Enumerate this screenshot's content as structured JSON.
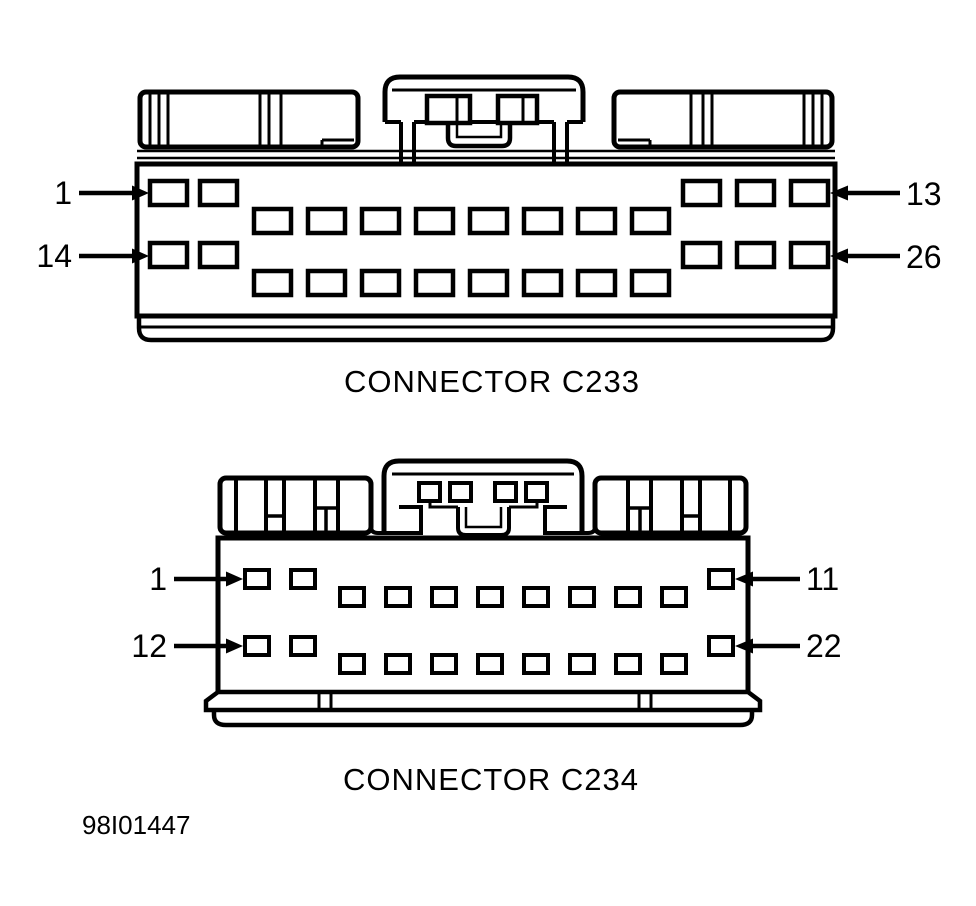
{
  "figure": {
    "code": "98I01447"
  },
  "colors": {
    "line": "#000000",
    "background": "#ffffff"
  },
  "connectors": [
    {
      "id": "C233",
      "caption": "CONNECTOR C233",
      "rows": 2,
      "pins_per_row": 13,
      "total_pins": 26,
      "pin_groups": [
        {
          "position": "left",
          "count": 2
        },
        {
          "position": "middle",
          "count": 8
        },
        {
          "position": "right",
          "count": 3
        }
      ],
      "callouts": [
        {
          "label": "1",
          "side": "left",
          "row": 1
        },
        {
          "label": "13",
          "side": "right",
          "row": 1
        },
        {
          "label": "14",
          "side": "left",
          "row": 2
        },
        {
          "label": "26",
          "side": "right",
          "row": 2
        }
      ]
    },
    {
      "id": "C234",
      "caption": "CONNECTOR C234",
      "rows": 2,
      "pins_per_row": 11,
      "total_pins": 22,
      "pin_groups": [
        {
          "position": "left",
          "count": 2
        },
        {
          "position": "middle",
          "count": 8
        },
        {
          "position": "right",
          "count": 1
        }
      ],
      "callouts": [
        {
          "label": "1",
          "side": "left",
          "row": 1
        },
        {
          "label": "11",
          "side": "right",
          "row": 1
        },
        {
          "label": "12",
          "side": "left",
          "row": 2
        },
        {
          "label": "22",
          "side": "right",
          "row": 2
        }
      ]
    }
  ]
}
